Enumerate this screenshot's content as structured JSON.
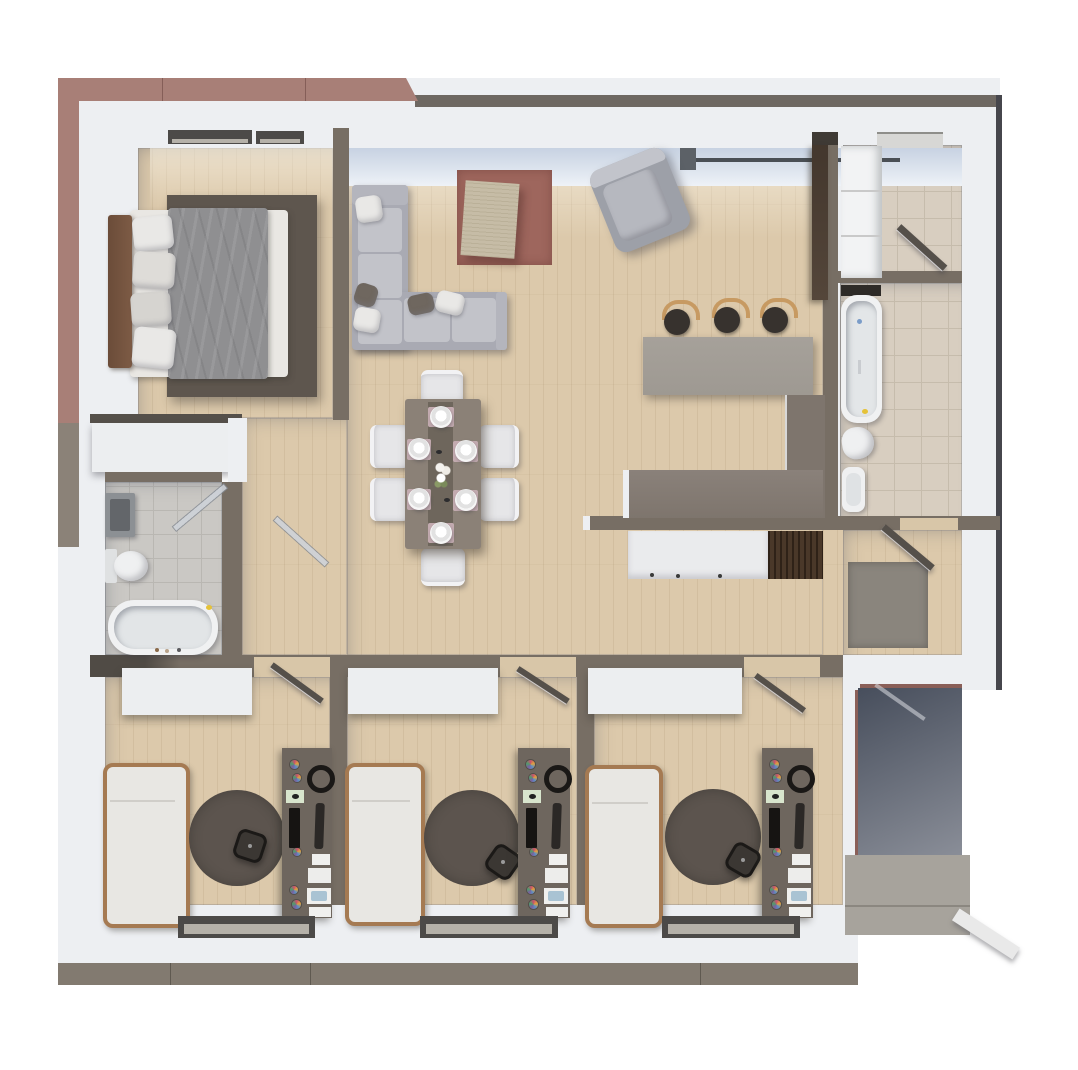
{
  "type": "floor-plan-3d-render",
  "title": "Apartment top-down 3D floor plan render",
  "visible_text": [],
  "palette": {
    "canvas": "#ffffff",
    "wallWhite": "#edeff2",
    "wallDark": "#776e64",
    "facadeMauve": "#a87f77",
    "facadeMauveDark": "#8a5f58",
    "facadeGray": "#8b8278",
    "roofEdge": "#6e6862",
    "edgeDark": "#46464c",
    "taupeBottom": "#827a70",
    "wood": "#dcc9ab",
    "tileBeige": "#d8cec0",
    "tileBeigeLine": "#c6bcac",
    "tileGray": "#cac8c4",
    "tileGrayLine": "#b9b7b2",
    "glassLight": "#eef2f7",
    "glassShade": "#c7d2e2",
    "mullion": "#5c6167",
    "lintelDark": "#4c4a48",
    "rugTerracotta": "#9e665d",
    "coffeeTable": "#c6bca6",
    "sofaShell": "#a9aab3",
    "sofaCushion": "#c2c3c9",
    "pillowWhite": "#e9e8e6",
    "pillowDark": "#6f675f",
    "armchairShell": "#9da0a8",
    "armchairSeat": "#b6b8bf",
    "diningTable": "#8b8177",
    "tableRunner": "#6e665c",
    "placemat": "#c3abb0",
    "chairWhite": "#e6e6e8",
    "barCounter": "#9e9992",
    "counterDark": "#7e756d",
    "counterWhite": "#eaebed",
    "stoveWood": "#4a3829",
    "stoolSeat": "#37322e",
    "stoolBack": "#c79a62",
    "cabinetBrown": "#54463a",
    "headboard": "#7d5b45",
    "duvet": "#8f8f91",
    "bedBase": "#e9e7e3",
    "rugBedroom": "#5e564e",
    "rugRound": "#5c544e",
    "wardrobeWhite": "#eceef0",
    "bedFrame": "#a57a52",
    "mattress": "#e8e7e3",
    "deskTop": "#6e665e",
    "officeChair": "#3b3733",
    "doorDark": "#55504a",
    "doorGlass": "rgba(205,210,216,0.9)",
    "matGray": "#8a857d",
    "porchShadowA": "#474e5c",
    "porchShadowB": "#8b8f99",
    "porchSlab": "#a7a39c",
    "railWhite": "#e9e9e9",
    "accentYellow": "#e5c238",
    "applianceWhite": "#f2f3f4",
    "padGreen": "#d8e5cd",
    "itemBlue": "#a9c3d3",
    "paperWhite": "#f0f0ee",
    "deviceBlack": "#161412",
    "fixtureWhite": "#eff0f1",
    "sinkGray": "#8c9094"
  },
  "scene": {
    "rooms": [
      {
        "name": "bedroom",
        "floor": "wood",
        "furniture": [
          "double-bed",
          "headboard",
          "pillows",
          "duvet",
          "area-rug",
          "wardrobe"
        ]
      },
      {
        "name": "living-room",
        "floor": "wood",
        "furniture": [
          "l-shaped-sofa",
          "throw-pillows",
          "terracotta-rug",
          "coffee-table",
          "armchair",
          "tall-cabinet"
        ]
      },
      {
        "name": "dining-area",
        "floor": "wood",
        "furniture": [
          "dining-table",
          "6-chairs",
          "6-place-settings",
          "table-runner",
          "flower-centerpiece"
        ]
      },
      {
        "name": "kitchen",
        "floor": "wood",
        "furniture": [
          "bar-counter",
          "3-bar-stools",
          "l-shaped-counter",
          "lower-counter",
          "wood-appliance-block"
        ]
      },
      {
        "name": "bathroom-left",
        "floor": "gray-tile",
        "furniture": [
          "sink",
          "toilet",
          "bathtub",
          "glass-door"
        ]
      },
      {
        "name": "bathroom-right",
        "floor": "beige-tile",
        "furniture": [
          "bathtub",
          "toilet",
          "bidet",
          "shelf-niche"
        ]
      },
      {
        "name": "wc-laundry",
        "floor": "beige-tile",
        "furniture": [
          "washer-dryer-stack",
          "door",
          "skylight"
        ]
      },
      {
        "name": "entry-hall",
        "floor": "wood",
        "furniture": [
          "doormat",
          "entry-door"
        ]
      },
      {
        "name": "office-room-1",
        "floor": "wood",
        "furniture": [
          "wardrobe",
          "single-bed",
          "round-rug",
          "office-chair",
          "desk",
          "keyboard",
          "monitor",
          "headphones",
          "desk-pad",
          "papers"
        ]
      },
      {
        "name": "office-room-2",
        "floor": "wood",
        "furniture": [
          "wardrobe",
          "single-bed",
          "round-rug",
          "office-chair",
          "desk",
          "keyboard",
          "monitor",
          "headphones",
          "desk-pad",
          "papers"
        ]
      },
      {
        "name": "office-room-3",
        "floor": "wood",
        "furniture": [
          "wardrobe",
          "single-bed",
          "round-rug",
          "office-chair",
          "desk",
          "keyboard",
          "monitor",
          "headphones",
          "desk-pad",
          "papers"
        ]
      },
      {
        "name": "porch",
        "floor": "concrete",
        "furniture": [
          "steps",
          "railing"
        ]
      }
    ]
  }
}
